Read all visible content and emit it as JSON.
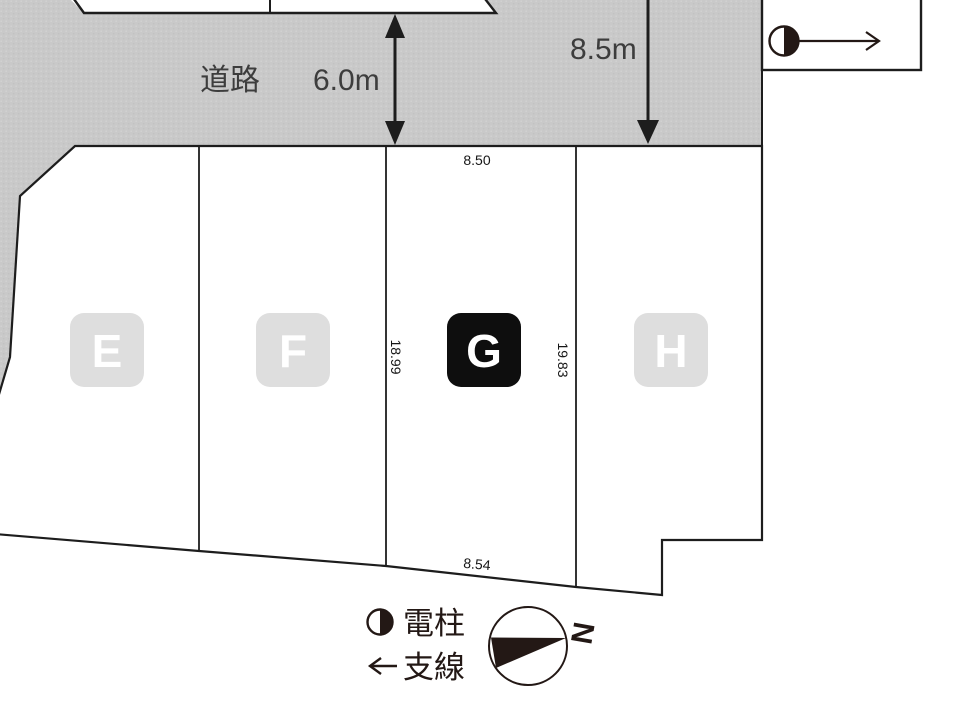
{
  "road": {
    "label": "道路",
    "width_label": "6.0m",
    "frontage_label": "8.5m"
  },
  "dimensions": {
    "top": "8.50",
    "left_side": "18.99",
    "right_side": "19.83",
    "bottom": "8.54"
  },
  "lots": [
    {
      "label": "E",
      "highlighted": false
    },
    {
      "label": "F",
      "highlighted": false
    },
    {
      "label": "G",
      "highlighted": true
    },
    {
      "label": "H",
      "highlighted": false
    }
  ],
  "legend": [
    {
      "icon": "utility-pole-icon",
      "label": "電柱"
    },
    {
      "icon": "arrow-left-icon",
      "label": "支線"
    }
  ],
  "compass": {
    "label": "N"
  },
  "colors": {
    "road_fill": "#c9c9c9",
    "road_dot": "#d3d3d3",
    "lot_fill": "#ffffff",
    "badge_fill": "#dedede",
    "badge_highlight_fill": "#0e0e0e",
    "badge_letter": "#ffffff",
    "line_ink": "#1d1d1d",
    "legend_ink": "#231815",
    "road_text": "#3d3d3d",
    "dim_text": "#161616"
  }
}
